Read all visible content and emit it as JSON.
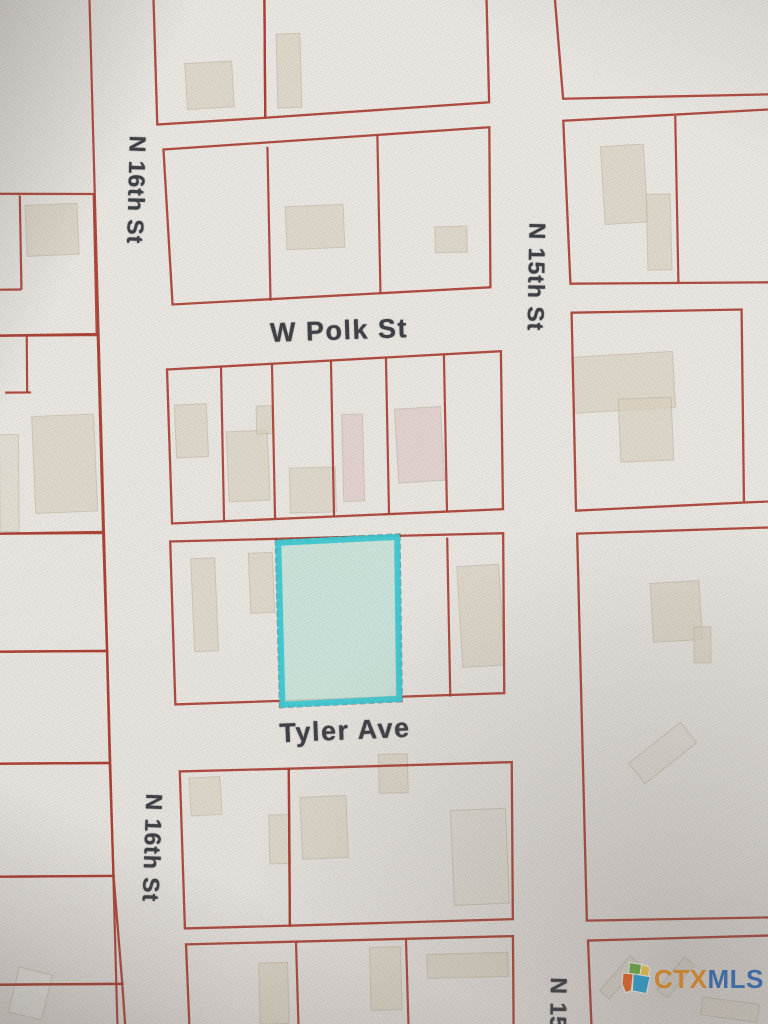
{
  "photo": {
    "width": 768,
    "height": 1024
  },
  "map": {
    "tilt": "rotate(-0.4 384 512)",
    "colors": {
      "paper": "#e9e6e2",
      "parcel_line": "#a8392d",
      "building_fill": "#d8d1c0",
      "building_pink": "#dcc9c6",
      "building_light": "#efede9",
      "building_stroke": "#b2a893",
      "label_text": "#393a41",
      "highlight_stroke": "#38c8d2",
      "highlight_fill": "#c3e2d8",
      "highlight_shadow": "#2c2c2c"
    },
    "streets": [
      {
        "name": "w-polk-st",
        "label": "W Polk St",
        "orientation": "horizontal"
      },
      {
        "name": "tyler-ave",
        "label": "Tyler Ave",
        "orientation": "horizontal"
      },
      {
        "name": "n-16th-st-upper",
        "label": "N 16th St",
        "orientation": "vertical"
      },
      {
        "name": "n-16th-st-lower",
        "label": "N 16th St",
        "orientation": "vertical"
      },
      {
        "name": "n-15th-st",
        "label": "N 15th St",
        "orientation": "vertical"
      },
      {
        "name": "n-15th-st-bottom",
        "label": "N 15t",
        "orientation": "vertical"
      }
    ],
    "parcels": [
      {
        "name": "parcel-west-1",
        "points": "-10,191 96,192 98,332 -10,333"
      },
      {
        "name": "parcel-west-2",
        "points": "-10,333 99,333 103,530 -10,531"
      },
      {
        "name": "parcel-west-3",
        "points": "-10,531 103,531 106,649 -10,649"
      },
      {
        "name": "parcel-west-4",
        "points": "-10,649 106,649 108,761 -10,761"
      },
      {
        "name": "parcel-west-5",
        "points": "-10,761 108,761 111,874 -10,874"
      },
      {
        "name": "parcel-west-6",
        "points": "-10,874 111,874 119,982 -10,982"
      },
      {
        "name": "parcel-west-7",
        "points": "-10,982 119,982 122,1030 -10,1030"
      },
      {
        "name": "parcel-central-north-left",
        "points": "157,-6 268,-6 268,117 160,123"
      },
      {
        "name": "parcel-central-north-right",
        "points": "268,-6 490,-6 492,103 268,117"
      },
      {
        "name": "parcel-block-north-of-polk",
        "points": "166,148 492,128 492,288 174,303"
      },
      {
        "name": "parcel-block-south-of-polk",
        "points": "168,368 502,352 503,510 172,522"
      },
      {
        "name": "parcel-block-north-of-tyler",
        "points": "170,540 503,534 503,694 174,703"
      },
      {
        "name": "parcel-block-south-of-tyler-left",
        "points": "178,770 287,768 287,925 182,927"
      },
      {
        "name": "parcel-block-south-of-tyler-right",
        "points": "287,768 510,763 510,920 287,925"
      },
      {
        "name": "parcel-block-bottom-central",
        "points": "183,943 510,937 510,1030 186,1030"
      },
      {
        "name": "parcel-east-top",
        "points": "558,-6 775,-6 775,97 566,100"
      },
      {
        "name": "parcel-east-2",
        "points": "566,122 775,112 775,285 572,285"
      },
      {
        "name": "parcel-east-3",
        "points": "573,314 743,312 744,505 576,512"
      },
      {
        "name": "parcel-east-4",
        "points": "577,535 775,530 775,920 584,922"
      },
      {
        "name": "parcel-east-bottom",
        "points": "585,942 775,938 775,1030 588,1030"
      }
    ],
    "parcel_lines": [
      [
        93,
        -5,
        114,
        1030
      ],
      [
        22,
        193,
        23,
        287
      ],
      [
        0,
        287,
        23,
        287
      ],
      [
        28,
        333,
        28,
        390
      ],
      [
        6,
        390,
        32,
        390
      ],
      [
        270,
        146,
        272,
        300
      ],
      [
        380,
        135,
        382,
        294
      ],
      [
        222,
        365,
        224,
        520
      ],
      [
        273,
        363,
        275,
        518
      ],
      [
        332,
        360,
        334,
        516
      ],
      [
        387,
        357,
        389,
        514
      ],
      [
        445,
        355,
        447,
        512
      ],
      [
        447,
        538,
        449,
        697
      ],
      [
        293,
        941,
        295,
        1030
      ],
      [
        403,
        939,
        405,
        1030
      ],
      [
        678,
        118,
        680,
        285
      ],
      [
        744,
        505,
        775,
        504
      ]
    ],
    "buildings": [
      {
        "rect": [
          189,
          61,
          47,
          46,
          -3
        ]
      },
      {
        "rect": [
          280,
          33,
          24,
          74,
          -1
        ]
      },
      {
        "rect": [
          288,
          205,
          58,
          43,
          -2
        ]
      },
      {
        "rect": [
          437,
          227,
          32,
          26,
          -1
        ]
      },
      {
        "rect": [
          605,
          147,
          43,
          78,
          -3
        ]
      },
      {
        "rect": [
          649,
          196,
          24,
          76,
          -1
        ]
      },
      {
        "rect": [
          28,
          202,
          52,
          51,
          -2
        ]
      },
      {
        "rect": [
          34,
          413,
          62,
          97,
          -2
        ]
      },
      {
        "rect": [
          0,
          432,
          19,
          97,
          0
        ],
        "opacity": 0.5
      },
      {
        "rect": [
          176,
          403,
          32,
          53,
          -2
        ]
      },
      {
        "rect": [
          228,
          430,
          41,
          70,
          -2
        ]
      },
      {
        "rect": [
          257,
          405,
          16,
          28,
          -1
        ]
      },
      {
        "rect": [
          290,
          467,
          46,
          45,
          -1
        ]
      },
      {
        "rect": [
          343,
          414,
          21,
          87,
          -1
        ],
        "tint": "pink"
      },
      {
        "rect": [
          397,
          408,
          46,
          74,
          -3
        ],
        "tint": "pink"
      },
      {
        "rect": [
          192,
          557,
          24,
          93,
          -2
        ]
      },
      {
        "rect": [
          249,
          552,
          24,
          60,
          -2
        ]
      },
      {
        "rect": [
          459,
          566,
          42,
          101,
          -3
        ]
      },
      {
        "rect": [
          188,
          776,
          31,
          38,
          -3
        ]
      },
      {
        "rect": [
          267,
          814,
          21,
          49,
          -1
        ]
      },
      {
        "rect": [
          299,
          796,
          46,
          62,
          -2
        ]
      },
      {
        "rect": [
          377,
          754,
          29,
          39,
          -1
        ]
      },
      {
        "rect": [
          450,
          810,
          55,
          95,
          -2
        ],
        "opacity": 0.32
      },
      {
        "rect": [
          256,
          962,
          29,
          61,
          -1
        ]
      },
      {
        "rect": [
          367,
          947,
          31,
          63,
          -1
        ]
      },
      {
        "rect": [
          424,
          954,
          81,
          24,
          -1
        ]
      },
      {
        "rect": [
          574,
          356,
          101,
          56,
          -3
        ]
      },
      {
        "rect": [
          620,
          400,
          53,
          63,
          -2
        ]
      },
      {
        "rect": [
          651,
          584,
          49,
          59,
          -3
        ]
      },
      {
        "rect": [
          693,
          629,
          17,
          36,
          0
        ]
      },
      {
        "rect": [
          628,
          742,
          66,
          26,
          -38
        ],
        "opacity": 0.22
      },
      {
        "rect": [
          610,
          956,
          13,
          46,
          42
        ],
        "opacity": 0.4
      },
      {
        "rect": [
          666,
          958,
          13,
          43,
          40
        ],
        "opacity": 0.4
      },
      {
        "rect": [
          698,
          1003,
          57,
          18,
          8
        ],
        "opacity": 0.35
      },
      {
        "rect": [
          10,
          968,
          34,
          46,
          14
        ],
        "tint": "light",
        "opacity": 0.5
      }
    ],
    "highlighted_parcel": {
      "points": "278,542 397,537 398,699 281,704"
    }
  },
  "watermark": {
    "ctx": "CTX",
    "mls": "MLS",
    "colors": {
      "ctx": "#f7941e",
      "mls": "#2e71c5",
      "icon_green": "#6cb33f",
      "icon_orange": "#f26722",
      "icon_blue": "#27a9e0",
      "icon_yellow": "#ffd24a"
    }
  }
}
